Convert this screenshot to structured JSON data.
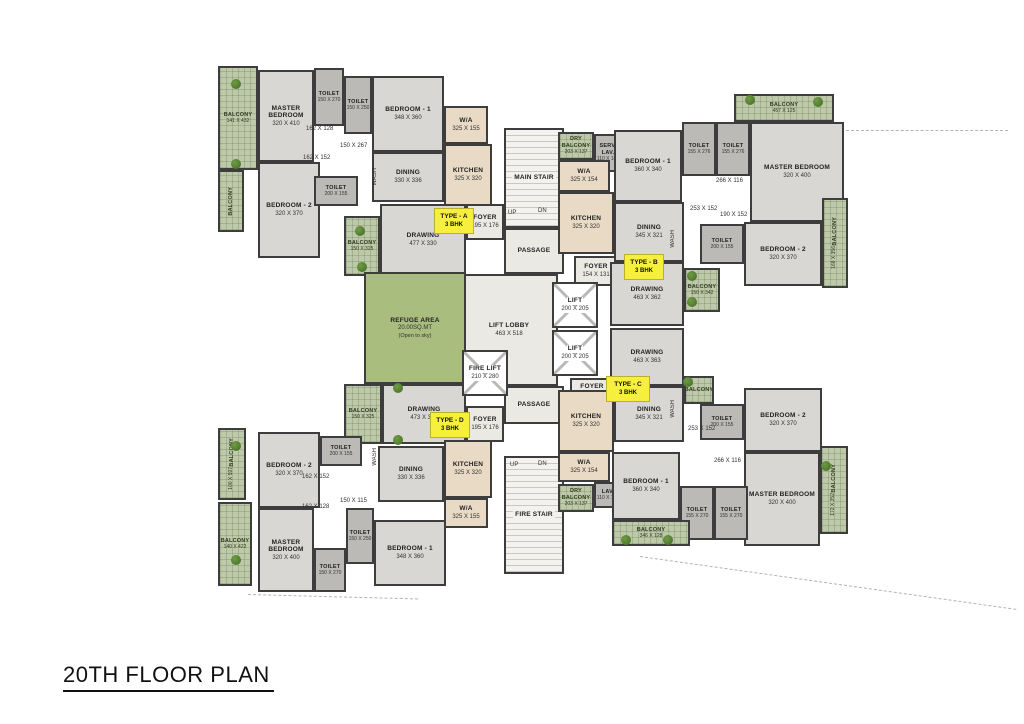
{
  "title": "20TH FLOOR PLAN",
  "colors": {
    "wall": "#3d3d3d",
    "floor": "#d8d7d3",
    "toilet_floor": "#bbbab6",
    "kitchen_floor": "#e8dac5",
    "balcony_green": "#bdc9a9",
    "refuge_green": "#a9bd7e",
    "core_floor": "#ebe9e4",
    "unit_chip_yellow": "#f7ef3e",
    "tree_green": "#4e7a2e"
  },
  "units": [
    {
      "id": "A",
      "label": "TYPE - A",
      "bhk": "3 BHK"
    },
    {
      "id": "B",
      "label": "TYPE - B",
      "bhk": "3 BHK"
    },
    {
      "id": "C",
      "label": "TYPE - C",
      "bhk": "3 BHK"
    },
    {
      "id": "D",
      "label": "TYPE - D",
      "bhk": "3 BHK"
    }
  ],
  "rooms": [
    {
      "id": "a-balcony-main",
      "name": "BALCONY",
      "dims": "141 X 432",
      "kind": "balcony",
      "x": 218,
      "y": 66,
      "w": 40,
      "h": 104
    },
    {
      "id": "a-balcony-left",
      "name": "BALCONY",
      "dims": "",
      "kind": "balcony",
      "x": 218,
      "y": 170,
      "w": 26,
      "h": 62,
      "vert": true
    },
    {
      "id": "a-master-bedroom",
      "name": "MASTER BEDROOM",
      "dims": "320 X 410",
      "kind": "room",
      "x": 258,
      "y": 70,
      "w": 56,
      "h": 92
    },
    {
      "id": "a-toilet-1",
      "name": "TOILET",
      "dims": "150 X 270",
      "kind": "toilet",
      "x": 314,
      "y": 68,
      "w": 30,
      "h": 58
    },
    {
      "id": "a-toilet-2",
      "name": "TOILET",
      "dims": "150 X 250",
      "kind": "toilet",
      "x": 344,
      "y": 76,
      "w": 28,
      "h": 58
    },
    {
      "id": "a-bedroom-1",
      "name": "BEDROOM - 1",
      "dims": "348 X 360",
      "kind": "room",
      "x": 372,
      "y": 76,
      "w": 72,
      "h": 76
    },
    {
      "id": "a-wa",
      "name": "W/A",
      "dims": "325 X 155",
      "kind": "kitchen",
      "x": 444,
      "y": 106,
      "w": 44,
      "h": 38
    },
    {
      "id": "a-kitchen",
      "name": "KITCHEN",
      "dims": "325 X 320",
      "kind": "kitchen",
      "x": 444,
      "y": 144,
      "w": 48,
      "h": 62
    },
    {
      "id": "a-bedroom-2",
      "name": "BEDROOM - 2",
      "dims": "320 X 370",
      "kind": "room",
      "x": 258,
      "y": 162,
      "w": 62,
      "h": 96
    },
    {
      "id": "a-toilet-3",
      "name": "TOILET",
      "dims": "200 X 155",
      "kind": "toilet",
      "x": 314,
      "y": 176,
      "w": 44,
      "h": 30
    },
    {
      "id": "a-dining",
      "name": "DINING",
      "dims": "330 X 336",
      "kind": "room",
      "x": 372,
      "y": 152,
      "w": 72,
      "h": 50
    },
    {
      "id": "a-drawing",
      "name": "DRAWING",
      "dims": "477 X 330",
      "kind": "room",
      "x": 380,
      "y": 204,
      "w": 86,
      "h": 72
    },
    {
      "id": "a-balcony-2",
      "name": "BALCONY",
      "dims": "150 X 325",
      "kind": "balcony",
      "x": 344,
      "y": 216,
      "w": 36,
      "h": 60
    },
    {
      "id": "a-foyer",
      "name": "FOYER",
      "dims": "195 X 176",
      "kind": "core",
      "x": 466,
      "y": 204,
      "w": 38,
      "h": 36
    },
    {
      "id": "core-main-stair",
      "name": "MAIN STAIR",
      "dims": "",
      "kind": "stair",
      "x": 504,
      "y": 128,
      "w": 60,
      "h": 100
    },
    {
      "id": "core-passage-top",
      "name": "PASSAGE",
      "dims": "",
      "kind": "core",
      "x": 504,
      "y": 228,
      "w": 60,
      "h": 46
    },
    {
      "id": "core-lift-lobby",
      "name": "LIFT LOBBY",
      "dims": "463 X 518",
      "kind": "core",
      "x": 460,
      "y": 274,
      "w": 98,
      "h": 112
    },
    {
      "id": "core-lift-1",
      "name": "LIFT",
      "dims": "200 X 205",
      "kind": "lift",
      "x": 552,
      "y": 282,
      "w": 46,
      "h": 46
    },
    {
      "id": "core-lift-2",
      "name": "LIFT",
      "dims": "200 X 205",
      "kind": "lift",
      "x": 552,
      "y": 330,
      "w": 46,
      "h": 46
    },
    {
      "id": "core-fire-lift",
      "name": "FIRE LIFT",
      "dims": "210 X 280",
      "kind": "lift",
      "x": 462,
      "y": 350,
      "w": 46,
      "h": 46
    },
    {
      "id": "core-foyer-b",
      "name": "FOYER",
      "dims": "154 X 131",
      "kind": "core",
      "x": 574,
      "y": 256,
      "w": 44,
      "h": 30
    },
    {
      "id": "core-foyer-c",
      "name": "FOYER",
      "dims": "154 X 131",
      "kind": "core",
      "x": 570,
      "y": 378,
      "w": 44,
      "h": 26
    },
    {
      "id": "core-passage-bottom",
      "name": "PASSAGE",
      "dims": "",
      "kind": "core",
      "x": 504,
      "y": 386,
      "w": 60,
      "h": 38
    },
    {
      "id": "core-fire-stair",
      "name": "FIRE STAIR",
      "dims": "",
      "kind": "stair",
      "x": 504,
      "y": 456,
      "w": 60,
      "h": 118
    },
    {
      "id": "refuge-area",
      "name": "REFUGE AREA",
      "dims": "20.00SQ.MT",
      "note": "(Open to sky)",
      "kind": "refuge",
      "x": 364,
      "y": 272,
      "w": 102,
      "h": 112
    },
    {
      "id": "b-dry-balcony",
      "name": "DRY BALCONY",
      "dims": "203 X 137",
      "kind": "balcony",
      "x": 558,
      "y": 132,
      "w": 36,
      "h": 28
    },
    {
      "id": "b-serv-lav",
      "name": "SERV. LAV.",
      "dims": "110 X 140",
      "kind": "toilet",
      "x": 594,
      "y": 134,
      "w": 28,
      "h": 38
    },
    {
      "id": "b-wa",
      "name": "W/A",
      "dims": "325 X 154",
      "kind": "kitchen",
      "x": 558,
      "y": 160,
      "w": 52,
      "h": 32
    },
    {
      "id": "b-kitchen",
      "name": "KITCHEN",
      "dims": "325 X 320",
      "kind": "kitchen",
      "x": 558,
      "y": 192,
      "w": 56,
      "h": 62
    },
    {
      "id": "b-bedroom-1",
      "name": "BEDROOM - 1",
      "dims": "360 X 340",
      "kind": "room",
      "x": 614,
      "y": 130,
      "w": 68,
      "h": 72
    },
    {
      "id": "b-toilet-1",
      "name": "TOILET",
      "dims": "155 X 276",
      "kind": "toilet",
      "x": 682,
      "y": 122,
      "w": 34,
      "h": 54
    },
    {
      "id": "b-toilet-2",
      "name": "TOILET",
      "dims": "155 X 276",
      "kind": "toilet",
      "x": 716,
      "y": 122,
      "w": 34,
      "h": 54
    },
    {
      "id": "b-balcony-top",
      "name": "BALCONY",
      "dims": "457 X 125",
      "kind": "balcony",
      "x": 734,
      "y": 94,
      "w": 100,
      "h": 28
    },
    {
      "id": "b-master-bedroom",
      "name": "MASTER BEDROOM",
      "dims": "320 X 400",
      "kind": "room",
      "x": 750,
      "y": 122,
      "w": 94,
      "h": 100
    },
    {
      "id": "b-dining",
      "name": "DINING",
      "dims": "345 X 321",
      "kind": "room",
      "x": 614,
      "y": 202,
      "w": 70,
      "h": 60
    },
    {
      "id": "b-toilet-3",
      "name": "TOILET",
      "dims": "200 X 155",
      "kind": "toilet",
      "x": 700,
      "y": 224,
      "w": 44,
      "h": 40
    },
    {
      "id": "b-bedroom-2",
      "name": "BEDROOM - 2",
      "dims": "320 X 370",
      "kind": "room",
      "x": 744,
      "y": 222,
      "w": 78,
      "h": 64
    },
    {
      "id": "b-balcony-right",
      "name": "BALCONY",
      "dims": "168 X 356",
      "kind": "balcony",
      "x": 822,
      "y": 198,
      "w": 26,
      "h": 90,
      "vert": true
    },
    {
      "id": "b-drawing",
      "name": "DRAWING",
      "dims": "463 X 362",
      "kind": "room",
      "x": 610,
      "y": 262,
      "w": 74,
      "h": 64
    },
    {
      "id": "b-balcony-bottom",
      "name": "BALCONY",
      "dims": "150 X 342",
      "kind": "balcony",
      "x": 684,
      "y": 268,
      "w": 36,
      "h": 44
    },
    {
      "id": "c-drawing",
      "name": "DRAWING",
      "dims": "463 X 363",
      "kind": "room",
      "x": 610,
      "y": 328,
      "w": 74,
      "h": 58
    },
    {
      "id": "c-dining",
      "name": "DINING",
      "dims": "345 X 321",
      "kind": "room",
      "x": 614,
      "y": 386,
      "w": 70,
      "h": 56
    },
    {
      "id": "c-kitchen",
      "name": "KITCHEN",
      "dims": "325 X 320",
      "kind": "kitchen",
      "x": 558,
      "y": 390,
      "w": 56,
      "h": 62
    },
    {
      "id": "c-wa",
      "name": "W/A",
      "dims": "325 X 154",
      "kind": "kitchen",
      "x": 558,
      "y": 452,
      "w": 52,
      "h": 30
    },
    {
      "id": "c-lav",
      "name": "LAV.",
      "dims": "110 X 140",
      "kind": "toilet",
      "x": 594,
      "y": 482,
      "w": 28,
      "h": 26
    },
    {
      "id": "c-dry-balcony",
      "name": "DRY BALCONY",
      "dims": "203 X 137",
      "kind": "balcony",
      "x": 558,
      "y": 484,
      "w": 36,
      "h": 28
    },
    {
      "id": "c-balcony-mid",
      "name": "BALCONY",
      "dims": "",
      "kind": "balcony",
      "x": 684,
      "y": 376,
      "w": 30,
      "h": 28
    },
    {
      "id": "c-toilet-1",
      "name": "TOILET",
      "dims": "200 X 155",
      "kind": "toilet",
      "x": 700,
      "y": 404,
      "w": 44,
      "h": 36
    },
    {
      "id": "c-bedroom-2",
      "name": "BEDROOM - 2",
      "dims": "320 X 370",
      "kind": "room",
      "x": 744,
      "y": 388,
      "w": 78,
      "h": 64
    },
    {
      "id": "c-master-bedroom",
      "name": "MASTER BEDROOM",
      "dims": "320 X 400",
      "kind": "room",
      "x": 744,
      "y": 452,
      "w": 76,
      "h": 94
    },
    {
      "id": "c-balcony-right",
      "name": "BALCONY",
      "dims": "172 X 352",
      "kind": "balcony",
      "x": 820,
      "y": 446,
      "w": 28,
      "h": 88,
      "vert": true
    },
    {
      "id": "c-bedroom-1",
      "name": "BEDROOM - 1",
      "dims": "360 X 340",
      "kind": "room",
      "x": 612,
      "y": 452,
      "w": 68,
      "h": 68
    },
    {
      "id": "c-toilet-2",
      "name": "TOILET",
      "dims": "155 X 270",
      "kind": "toilet",
      "x": 680,
      "y": 486,
      "w": 34,
      "h": 54
    },
    {
      "id": "c-toilet-3",
      "name": "TOILET",
      "dims": "155 X 270",
      "kind": "toilet",
      "x": 714,
      "y": 486,
      "w": 34,
      "h": 54
    },
    {
      "id": "c-balcony-bottom",
      "name": "BALCONY",
      "dims": "346 X 128",
      "kind": "balcony",
      "x": 612,
      "y": 520,
      "w": 78,
      "h": 26
    },
    {
      "id": "d-balcony-top",
      "name": "BALCONY",
      "dims": "150 X 325",
      "kind": "balcony",
      "x": 344,
      "y": 384,
      "w": 38,
      "h": 60
    },
    {
      "id": "d-drawing",
      "name": "DRAWING",
      "dims": "473 X 330",
      "kind": "room",
      "x": 382,
      "y": 384,
      "w": 84,
      "h": 60
    },
    {
      "id": "d-foyer",
      "name": "FOYER",
      "dims": "195 X 176",
      "kind": "core",
      "x": 466,
      "y": 406,
      "w": 38,
      "h": 36
    },
    {
      "id": "d-bedroom-2",
      "name": "BEDROOM - 2",
      "dims": "320 X 370",
      "kind": "room",
      "x": 258,
      "y": 432,
      "w": 62,
      "h": 76
    },
    {
      "id": "d-toilet-1",
      "name": "TOILET",
      "dims": "200 X 155",
      "kind": "toilet",
      "x": 320,
      "y": 436,
      "w": 42,
      "h": 30
    },
    {
      "id": "d-dining",
      "name": "DINING",
      "dims": "330 X 336",
      "kind": "room",
      "x": 378,
      "y": 446,
      "w": 66,
      "h": 56
    },
    {
      "id": "d-kitchen",
      "name": "KITCHEN",
      "dims": "325 X 320",
      "kind": "kitchen",
      "x": 444,
      "y": 440,
      "w": 48,
      "h": 58
    },
    {
      "id": "d-wa",
      "name": "W/A",
      "dims": "325 X 155",
      "kind": "kitchen",
      "x": 444,
      "y": 498,
      "w": 44,
      "h": 30
    },
    {
      "id": "d-master-bedroom",
      "name": "MASTER BEDROOM",
      "dims": "320 X 400",
      "kind": "room",
      "x": 258,
      "y": 508,
      "w": 56,
      "h": 84
    },
    {
      "id": "d-toilet-2",
      "name": "TOILET",
      "dims": "150 X 250",
      "kind": "toilet",
      "x": 346,
      "y": 508,
      "w": 28,
      "h": 56
    },
    {
      "id": "d-toilet-3",
      "name": "TOILET",
      "dims": "150 X 270",
      "kind": "toilet",
      "x": 314,
      "y": 548,
      "w": 32,
      "h": 44
    },
    {
      "id": "d-bedroom-1",
      "name": "BEDROOM - 1",
      "dims": "348 X 360",
      "kind": "room",
      "x": 374,
      "y": 520,
      "w": 72,
      "h": 66
    },
    {
      "id": "d-balcony-left",
      "name": "BALCONY",
      "dims": "100 X 597",
      "kind": "balcony",
      "x": 218,
      "y": 428,
      "w": 28,
      "h": 72,
      "vert": true
    },
    {
      "id": "d-balcony-bottom",
      "name": "BALCONY",
      "dims": "140 X 422",
      "kind": "balcony",
      "x": 218,
      "y": 502,
      "w": 34,
      "h": 84
    }
  ],
  "chips": [
    {
      "id": "chip-type-a",
      "label": "TYPE - A",
      "bhk": "3 BHK",
      "x": 434,
      "y": 208,
      "w": 38,
      "h": 24
    },
    {
      "id": "chip-type-b",
      "label": "TYPE - B",
      "bhk": "3 BHK",
      "x": 624,
      "y": 254,
      "w": 38,
      "h": 24
    },
    {
      "id": "chip-type-c",
      "label": "TYPE - C",
      "bhk": "3 BHK",
      "x": 606,
      "y": 376,
      "w": 42,
      "h": 24
    },
    {
      "id": "chip-type-d",
      "label": "TYPE - D",
      "bhk": "3 BHK",
      "x": 430,
      "y": 412,
      "w": 38,
      "h": 24
    }
  ],
  "dim_labels": [
    {
      "text": "150 X 267",
      "x": 340,
      "y": 143
    },
    {
      "text": "162 X 128",
      "x": 306,
      "y": 126
    },
    {
      "text": "162 X 152",
      "x": 303,
      "y": 155
    },
    {
      "text": "WASH",
      "x": 372,
      "y": 168,
      "vert": true
    },
    {
      "text": "266 X 116",
      "x": 716,
      "y": 178
    },
    {
      "text": "253 X 152",
      "x": 690,
      "y": 206
    },
    {
      "text": "190 X 152",
      "x": 720,
      "y": 212
    },
    {
      "text": "WASH",
      "x": 670,
      "y": 230,
      "vert": true
    },
    {
      "text": "253 X 152",
      "x": 688,
      "y": 426
    },
    {
      "text": "266 X 116",
      "x": 714,
      "y": 458
    },
    {
      "text": "WASH",
      "x": 670,
      "y": 400,
      "vert": true
    },
    {
      "text": "162 X 152",
      "x": 302,
      "y": 474
    },
    {
      "text": "150 X 115",
      "x": 340,
      "y": 498
    },
    {
      "text": "162 X 128",
      "x": 302,
      "y": 504
    },
    {
      "text": "WASH",
      "x": 372,
      "y": 448,
      "vert": true
    },
    {
      "text": "UP",
      "x": 508,
      "y": 210
    },
    {
      "text": "DN",
      "x": 538,
      "y": 208
    },
    {
      "text": "UP",
      "x": 510,
      "y": 462
    },
    {
      "text": "DN",
      "x": 538,
      "y": 461
    }
  ],
  "trees": [
    {
      "x": 236,
      "y": 84
    },
    {
      "x": 236,
      "y": 164
    },
    {
      "x": 360,
      "y": 231
    },
    {
      "x": 362,
      "y": 267
    },
    {
      "x": 750,
      "y": 100
    },
    {
      "x": 818,
      "y": 102
    },
    {
      "x": 692,
      "y": 276
    },
    {
      "x": 692,
      "y": 302
    },
    {
      "x": 688,
      "y": 382
    },
    {
      "x": 826,
      "y": 466
    },
    {
      "x": 398,
      "y": 388
    },
    {
      "x": 398,
      "y": 440
    },
    {
      "x": 236,
      "y": 446
    },
    {
      "x": 236,
      "y": 560
    },
    {
      "x": 626,
      "y": 540
    },
    {
      "x": 668,
      "y": 540
    }
  ],
  "dashes": [
    {
      "x": 846,
      "y": 130,
      "len": 162,
      "rot": 0
    },
    {
      "x": 640,
      "y": 556,
      "len": 380,
      "rot": 8
    },
    {
      "x": 248,
      "y": 594,
      "len": 170,
      "rot": 1.5
    }
  ]
}
